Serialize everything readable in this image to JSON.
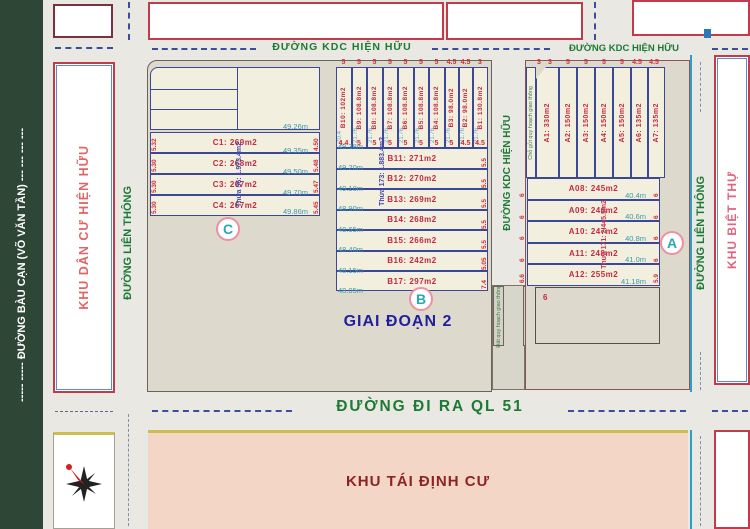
{
  "roads": {
    "bau_can_full": "----- ----- ĐƯỜNG BÀU CẠN (VÕ VĂN TẦN) --- --- --- ---",
    "kdc_top_left": "ĐƯỜNG KDC HIỆN HỮU",
    "kdc_top_right": "ĐƯỜNG KDC HIỆN HỮU",
    "lien_thong_left": "ĐƯỜNG LIÊN THÔNG",
    "kdc_mid": "ĐƯỜNG KDC HIỆN HỮU",
    "lien_thong_right": "ĐƯỜNG LIÊN THÔNG",
    "ql51": "ĐƯỜNG ĐI RA QL 51"
  },
  "areas": {
    "khu_dan_cu": "KHU DÂN CƯ HIỆN HỮU",
    "khu_biet_thu": "KHU BIỆT THỰ",
    "khu_tai_dinh_cu": "KHU TÁI ĐỊNH CƯ",
    "giai_doan_2": "GIAI ĐOẠN 2"
  },
  "markers": {
    "a": "A",
    "b": "B",
    "c": "C"
  },
  "blocks": {
    "thua_86": {
      "title": "Thửa 86: 1.082m2",
      "lots": [
        {
          "label": "B10: 102m2",
          "top": "5",
          "bottom": "4.4",
          "depth": "20.4"
        },
        {
          "label": "B9: 108.8m2",
          "top": "5",
          "bottom": "5",
          "depth": "21.76"
        },
        {
          "label": "B8: 108.8m2",
          "top": "5",
          "bottom": "5",
          "depth": "21.76"
        },
        {
          "label": "B7: 108.8m2",
          "top": "5",
          "bottom": "5",
          "depth": "21.76"
        },
        {
          "label": "B6: 108.8m2",
          "top": "5",
          "bottom": "5",
          "depth": "21.76"
        },
        {
          "label": "B5: 108.8m2",
          "top": "5",
          "bottom": "5",
          "depth": "21.76"
        },
        {
          "label": "B4: 108.8m2",
          "top": "5",
          "bottom": "5",
          "depth": "21.76"
        },
        {
          "label": "B3: 98.0m2",
          "top": "4.5",
          "bottom": "5",
          "depth": "21.76"
        },
        {
          "label": "B2: 98.0m2",
          "top": "4.5",
          "bottom": "4.5",
          "depth": "21.76"
        },
        {
          "label": "B1: 130.8m2",
          "top": "3",
          "bottom": "4.5",
          "depth": "21.76"
        }
      ]
    },
    "thua_56": {
      "title": "Thửa 56: 1.973.4m2",
      "top_measure": "49.26m",
      "lots": [
        {
          "label": "C1: 269m2",
          "left": "5.32",
          "right": "4.50",
          "measure": "49.35m"
        },
        {
          "label": "C2: 268m2",
          "left": "5.30",
          "right": "5.48",
          "measure": "49.50m"
        },
        {
          "label": "C3: 267m2",
          "left": "5.30",
          "right": "5.47",
          "measure": "49.70m"
        },
        {
          "label": "C4: 267m2",
          "left": "5.30",
          "right": "5.45",
          "measure": "49.86m"
        }
      ]
    },
    "thua_173": {
      "title": "Thửa 173: 1.883.4m2",
      "top_measure": "49.38m",
      "lots": [
        {
          "label": "B11: 271m2",
          "right": "5.5",
          "measure": "49.20m"
        },
        {
          "label": "B12: 270m2",
          "right": "5.5",
          "measure": "49.10m"
        },
        {
          "label": "B13: 269m2",
          "right": "5.5",
          "measure": "48.90m"
        },
        {
          "label": "B14: 268m2",
          "right": "5.5",
          "measure": "48.65m"
        },
        {
          "label": "B15: 266m2",
          "right": "5.5",
          "measure": "48.40m"
        },
        {
          "label": "B16: 242m2",
          "right": "5.05",
          "measure": "48.15m"
        },
        {
          "label": "B17: 297m2",
          "right": "7.4",
          "measure": "48.05m"
        }
      ]
    },
    "a_row": {
      "lots": [
        {
          "label": "A1: 330m2",
          "top": "3",
          "top2": "3",
          "bottom": "4.83",
          "bottom2": "4.38"
        },
        {
          "label": "A2: 150m2",
          "top": "5",
          "bottom": "5"
        },
        {
          "label": "A3: 150m2",
          "top": "5",
          "bottom": "5"
        },
        {
          "label": "A4: 150m2",
          "top": "5",
          "bottom": "5"
        },
        {
          "label": "A5: 150m2",
          "top": "5",
          "bottom": "5"
        },
        {
          "label": "A6: 135m2",
          "top": "4.5",
          "bottom": "4.5"
        },
        {
          "label": "A7: 135m2",
          "top": "4.5",
          "bottom": "4.5"
        }
      ]
    },
    "thua_171": {
      "title": "Thửa 171: 2.445.5m2",
      "lots": [
        {
          "label": "A08: 245m2",
          "left": "6",
          "right": "6",
          "measure": "40.4m"
        },
        {
          "label": "A09: 246m2",
          "left": "6",
          "right": "6",
          "measure": "40.6m"
        },
        {
          "label": "A10: 247m2",
          "left": "6",
          "right": "6",
          "measure": "40.8m"
        },
        {
          "label": "A11: 248m2",
          "left": "6",
          "right": "6",
          "measure": "41.0m"
        },
        {
          "label": "A12: 255m2",
          "left": "6.6",
          "right": "5.9",
          "measure": "41.18m"
        }
      ]
    }
  },
  "strips": {
    "left": "Đất quy hoạch giao thông",
    "right": "Chỗ gửi quy hoạch giao thông",
    "a_top": "Chỗ gửi quy hoạch giao thông",
    "reserved_mark": "6"
  },
  "colors": {
    "lot_border": "#3a4896",
    "lot_label": "#c22a40",
    "measure": "#3a9aae",
    "road_text": "#1d7a34",
    "thua_blue": "#4646a8",
    "thua_red": "#c23b55",
    "pink_area": "#f3d6c6",
    "green_strip": "#2e4636"
  }
}
